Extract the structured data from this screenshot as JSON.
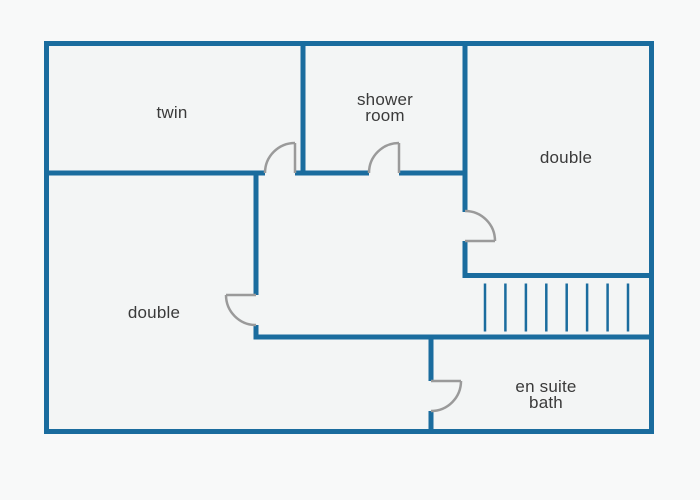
{
  "diagram": {
    "type": "floor-plan",
    "colors": {
      "page_bg": "#f8f9f9",
      "room_fill": "#f3f5f5",
      "wall": "#1a6c9e",
      "door": "#9a9a9a",
      "label": "#3a3a3a"
    },
    "rooms": [
      {
        "key": "twin",
        "label": "twin",
        "lines": [
          "twin"
        ]
      },
      {
        "key": "shower-room",
        "label": "shower room",
        "lines": [
          "shower",
          "room"
        ]
      },
      {
        "key": "double-right",
        "label": "double",
        "lines": [
          "double"
        ]
      },
      {
        "key": "double-left",
        "label": "double",
        "lines": [
          "double"
        ]
      },
      {
        "key": "ensuite-bath",
        "label": "en suite bath",
        "lines": [
          "en suite",
          "bath"
        ]
      }
    ],
    "stairs": {
      "tread_count": 8
    },
    "doors": [
      {
        "key": "door-twin",
        "opens_into": "twin"
      },
      {
        "key": "door-shower-room",
        "opens_into": "shower room"
      },
      {
        "key": "door-double-right",
        "opens_into": "double (right)"
      },
      {
        "key": "door-double-left",
        "opens_into": "double (left)"
      },
      {
        "key": "door-ensuite-bath",
        "opens_into": "en suite bath"
      }
    ]
  }
}
